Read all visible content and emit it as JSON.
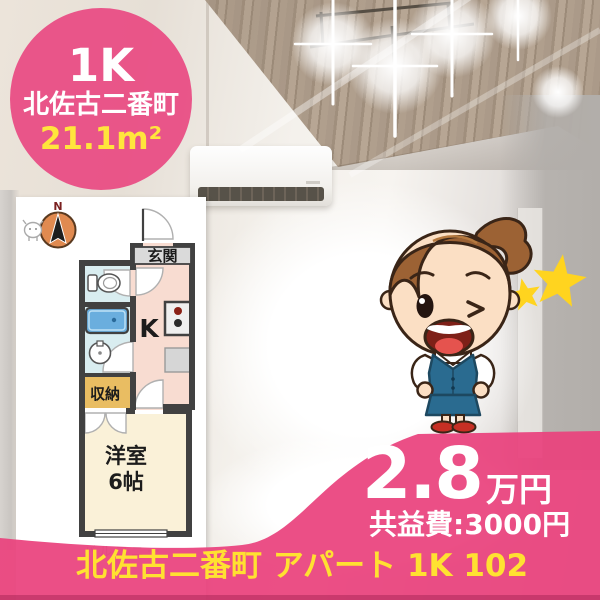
{
  "badge": {
    "plan_type": "1K",
    "location": "北佐古二番町",
    "area": "21.1m²"
  },
  "floorplan": {
    "compass_label": "N",
    "entrance_label": "玄関",
    "kitchen_label": "K",
    "storage_label": "収納",
    "room_label_line1": "洋室",
    "room_label_line2": "6帖",
    "balcony_label": "バルコニー"
  },
  "price": {
    "rent": "2.8",
    "unit": "万円",
    "common_fee": "共益費:3000円"
  },
  "footer": {
    "listing_title": "北佐古二番町 アパート 1K 102"
  },
  "icons": {
    "compass": "north-compass-icon",
    "toilet": "toilet-icon",
    "bathtub": "bathtub-icon",
    "sink": "sink-icon",
    "stove": "stove-icon",
    "stars": "star-icon",
    "mascot": "agent-mascot"
  },
  "colors": {
    "accent_pink": "#e93e7c",
    "footer_yellow": "#ffe131",
    "area_yellow": "#ffe53c",
    "plan_wall": "#414141"
  }
}
